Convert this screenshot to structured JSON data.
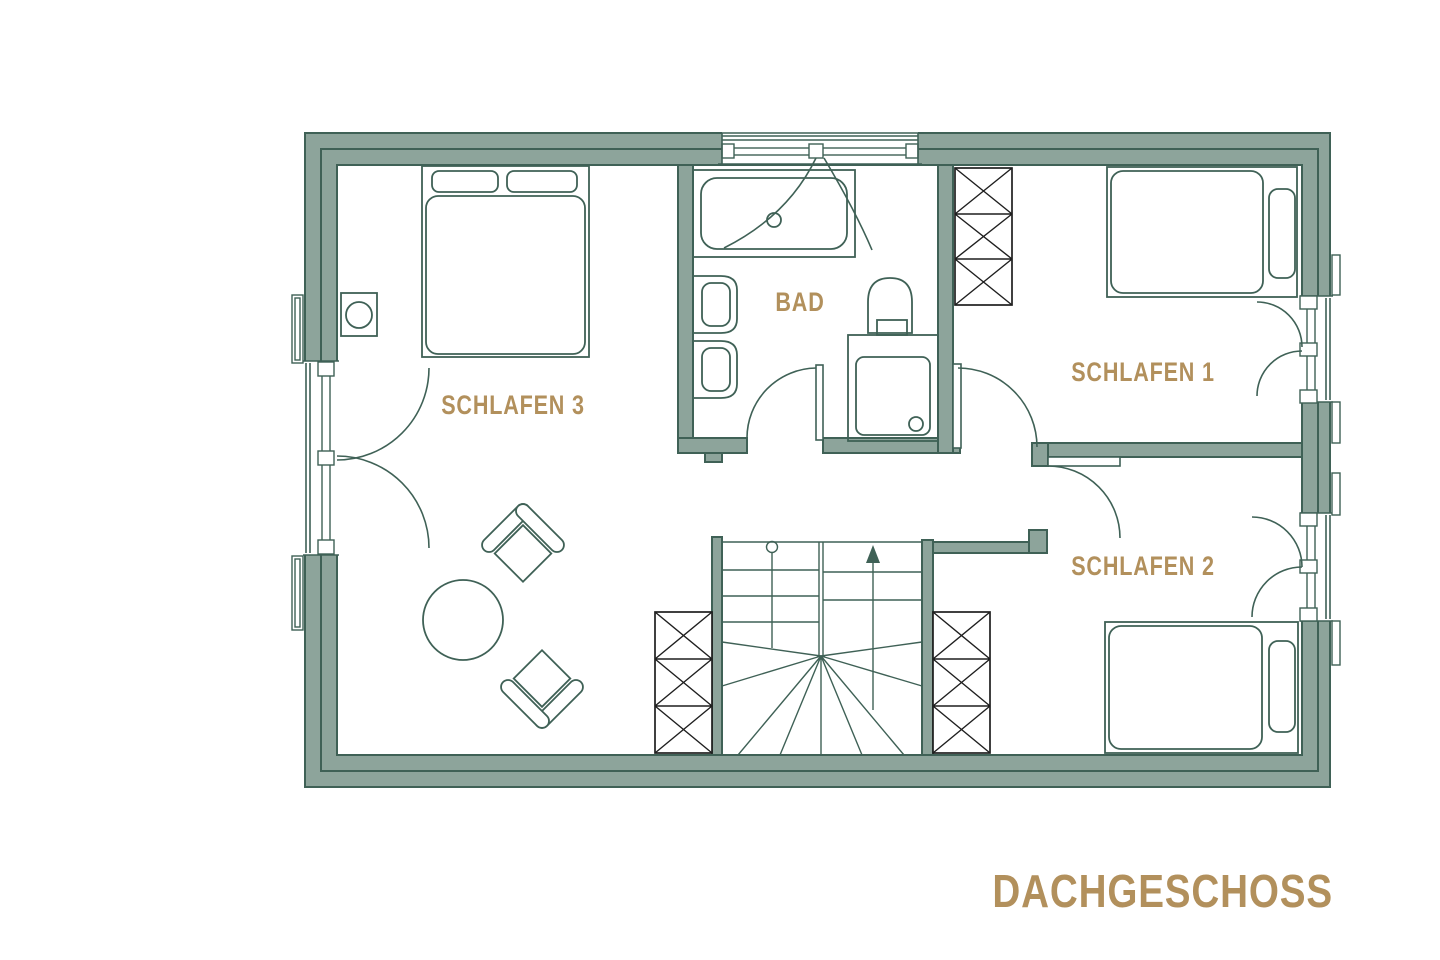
{
  "title": "DACHGESCHOSS",
  "rooms": {
    "schlafen3": {
      "label": "SCHLAFEN 3"
    },
    "bad": {
      "label": "BAD"
    },
    "schlafen1": {
      "label": "SCHLAFEN 1"
    },
    "schlafen2": {
      "label": "SCHLAFEN 2"
    }
  },
  "colors": {
    "wall": "#8da49b",
    "line": "#3f6156",
    "accent": "#b2905c",
    "dark": "#1f1f1f",
    "bg": "#ffffff"
  }
}
